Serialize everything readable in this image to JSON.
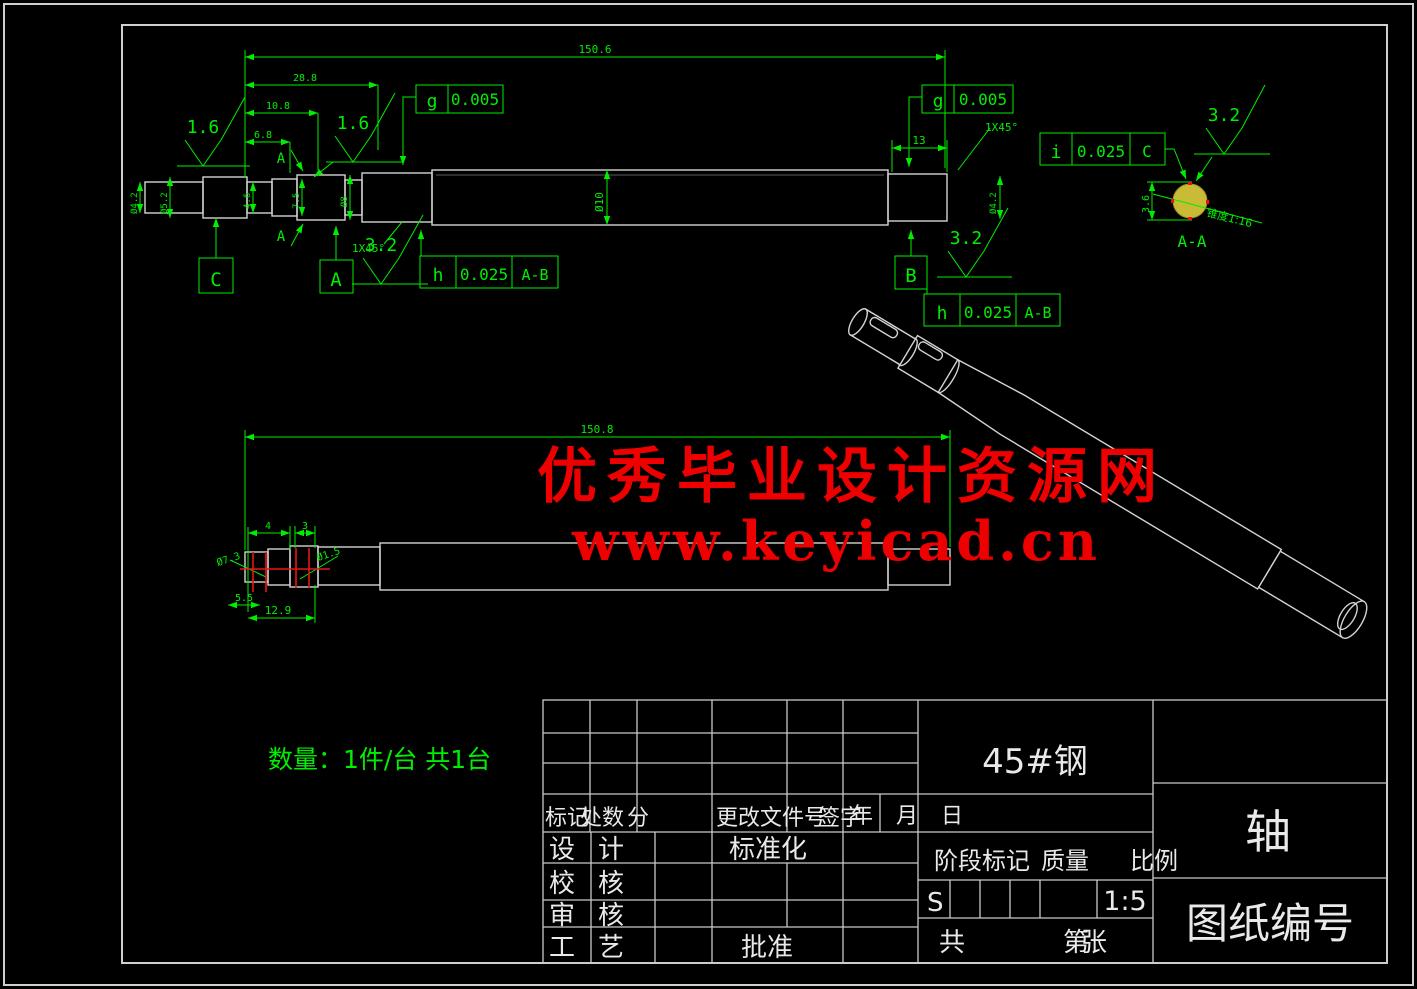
{
  "colors": {
    "background": "#000000",
    "line_green": "#00ef00",
    "geometry_gray": "#d4d4d4",
    "watermark_red": "#ee0000",
    "section_fill_yellow": "#c9bb35",
    "keyway_red": "#e81414",
    "title_text_white": "#e9e9e9"
  },
  "watermark": {
    "line1": "优秀毕业设计资源网",
    "line2": "www.keyicad.cn"
  },
  "notes": {
    "quantity": "数量：1件/台 共1台"
  },
  "front_view": {
    "dims": {
      "overall": "150.6",
      "step1": "28.8",
      "step2": "10.8",
      "step3": "6.8",
      "right_len": "13",
      "dia_mid": "Ø10",
      "dia_left_a": "Ø4.2",
      "dia_left_b": "Ø5.2",
      "seg_a": "4.6",
      "seg_b": "7.5",
      "seg_c": "Ø8",
      "dia_right": "Ø4.2",
      "chamfer_left": "1X45°",
      "chamfer_right": "1X45°"
    },
    "roughness": {
      "left": "1.6",
      "mid": "1.6",
      "bottom_left": "3.2",
      "bottom_right": "3.2"
    },
    "frames": {
      "g_left": {
        "sym": "g",
        "val": "0.005"
      },
      "g_right": {
        "sym": "g",
        "val": "0.005"
      },
      "h_left": {
        "sym": "h",
        "val": "0.025",
        "ref": "A-B"
      },
      "h_right": {
        "sym": "h",
        "val": "0.025",
        "ref": "A-B"
      },
      "i": {
        "sym": "i",
        "val": "0.025",
        "ref": "C"
      }
    },
    "datums": {
      "a": "A",
      "b": "B",
      "c": "C"
    },
    "section_letter": "A"
  },
  "section_view": {
    "label": "A-A",
    "roughness": "3.2",
    "taper": "锥度1:16",
    "dim": "3.6"
  },
  "bottom_view": {
    "dims": {
      "overall": "150.8",
      "key1_len": "4",
      "key2_len": "3",
      "key1_dia": "Ø7.3",
      "key2_dia": "Ø1.5",
      "depth": "5.5",
      "span": "12.9"
    }
  },
  "title_block": {
    "material": "45#钢",
    "part_name": "轴",
    "drawing_no": "图纸编号",
    "scale_value": "1:5",
    "s": "S",
    "headers": {
      "stage": "阶段标记",
      "mass": "质量",
      "scale": "比例",
      "total": "共",
      "sheet": "第",
      "sheet_unit": "张"
    },
    "rev": {
      "mark": "标记",
      "count": "处数",
      "zone": "分",
      "doc": "更改文件号",
      "sign": "签字",
      "year": "年",
      "month": "月",
      "day": "日"
    },
    "roles": {
      "design_a": "设",
      "design_b": "计",
      "std": "标准化",
      "check_a": "校",
      "check_b": "核",
      "audit_a": "审",
      "audit_b": "核",
      "craft_a": "工",
      "craft_b": "艺",
      "approve": "批准"
    }
  }
}
